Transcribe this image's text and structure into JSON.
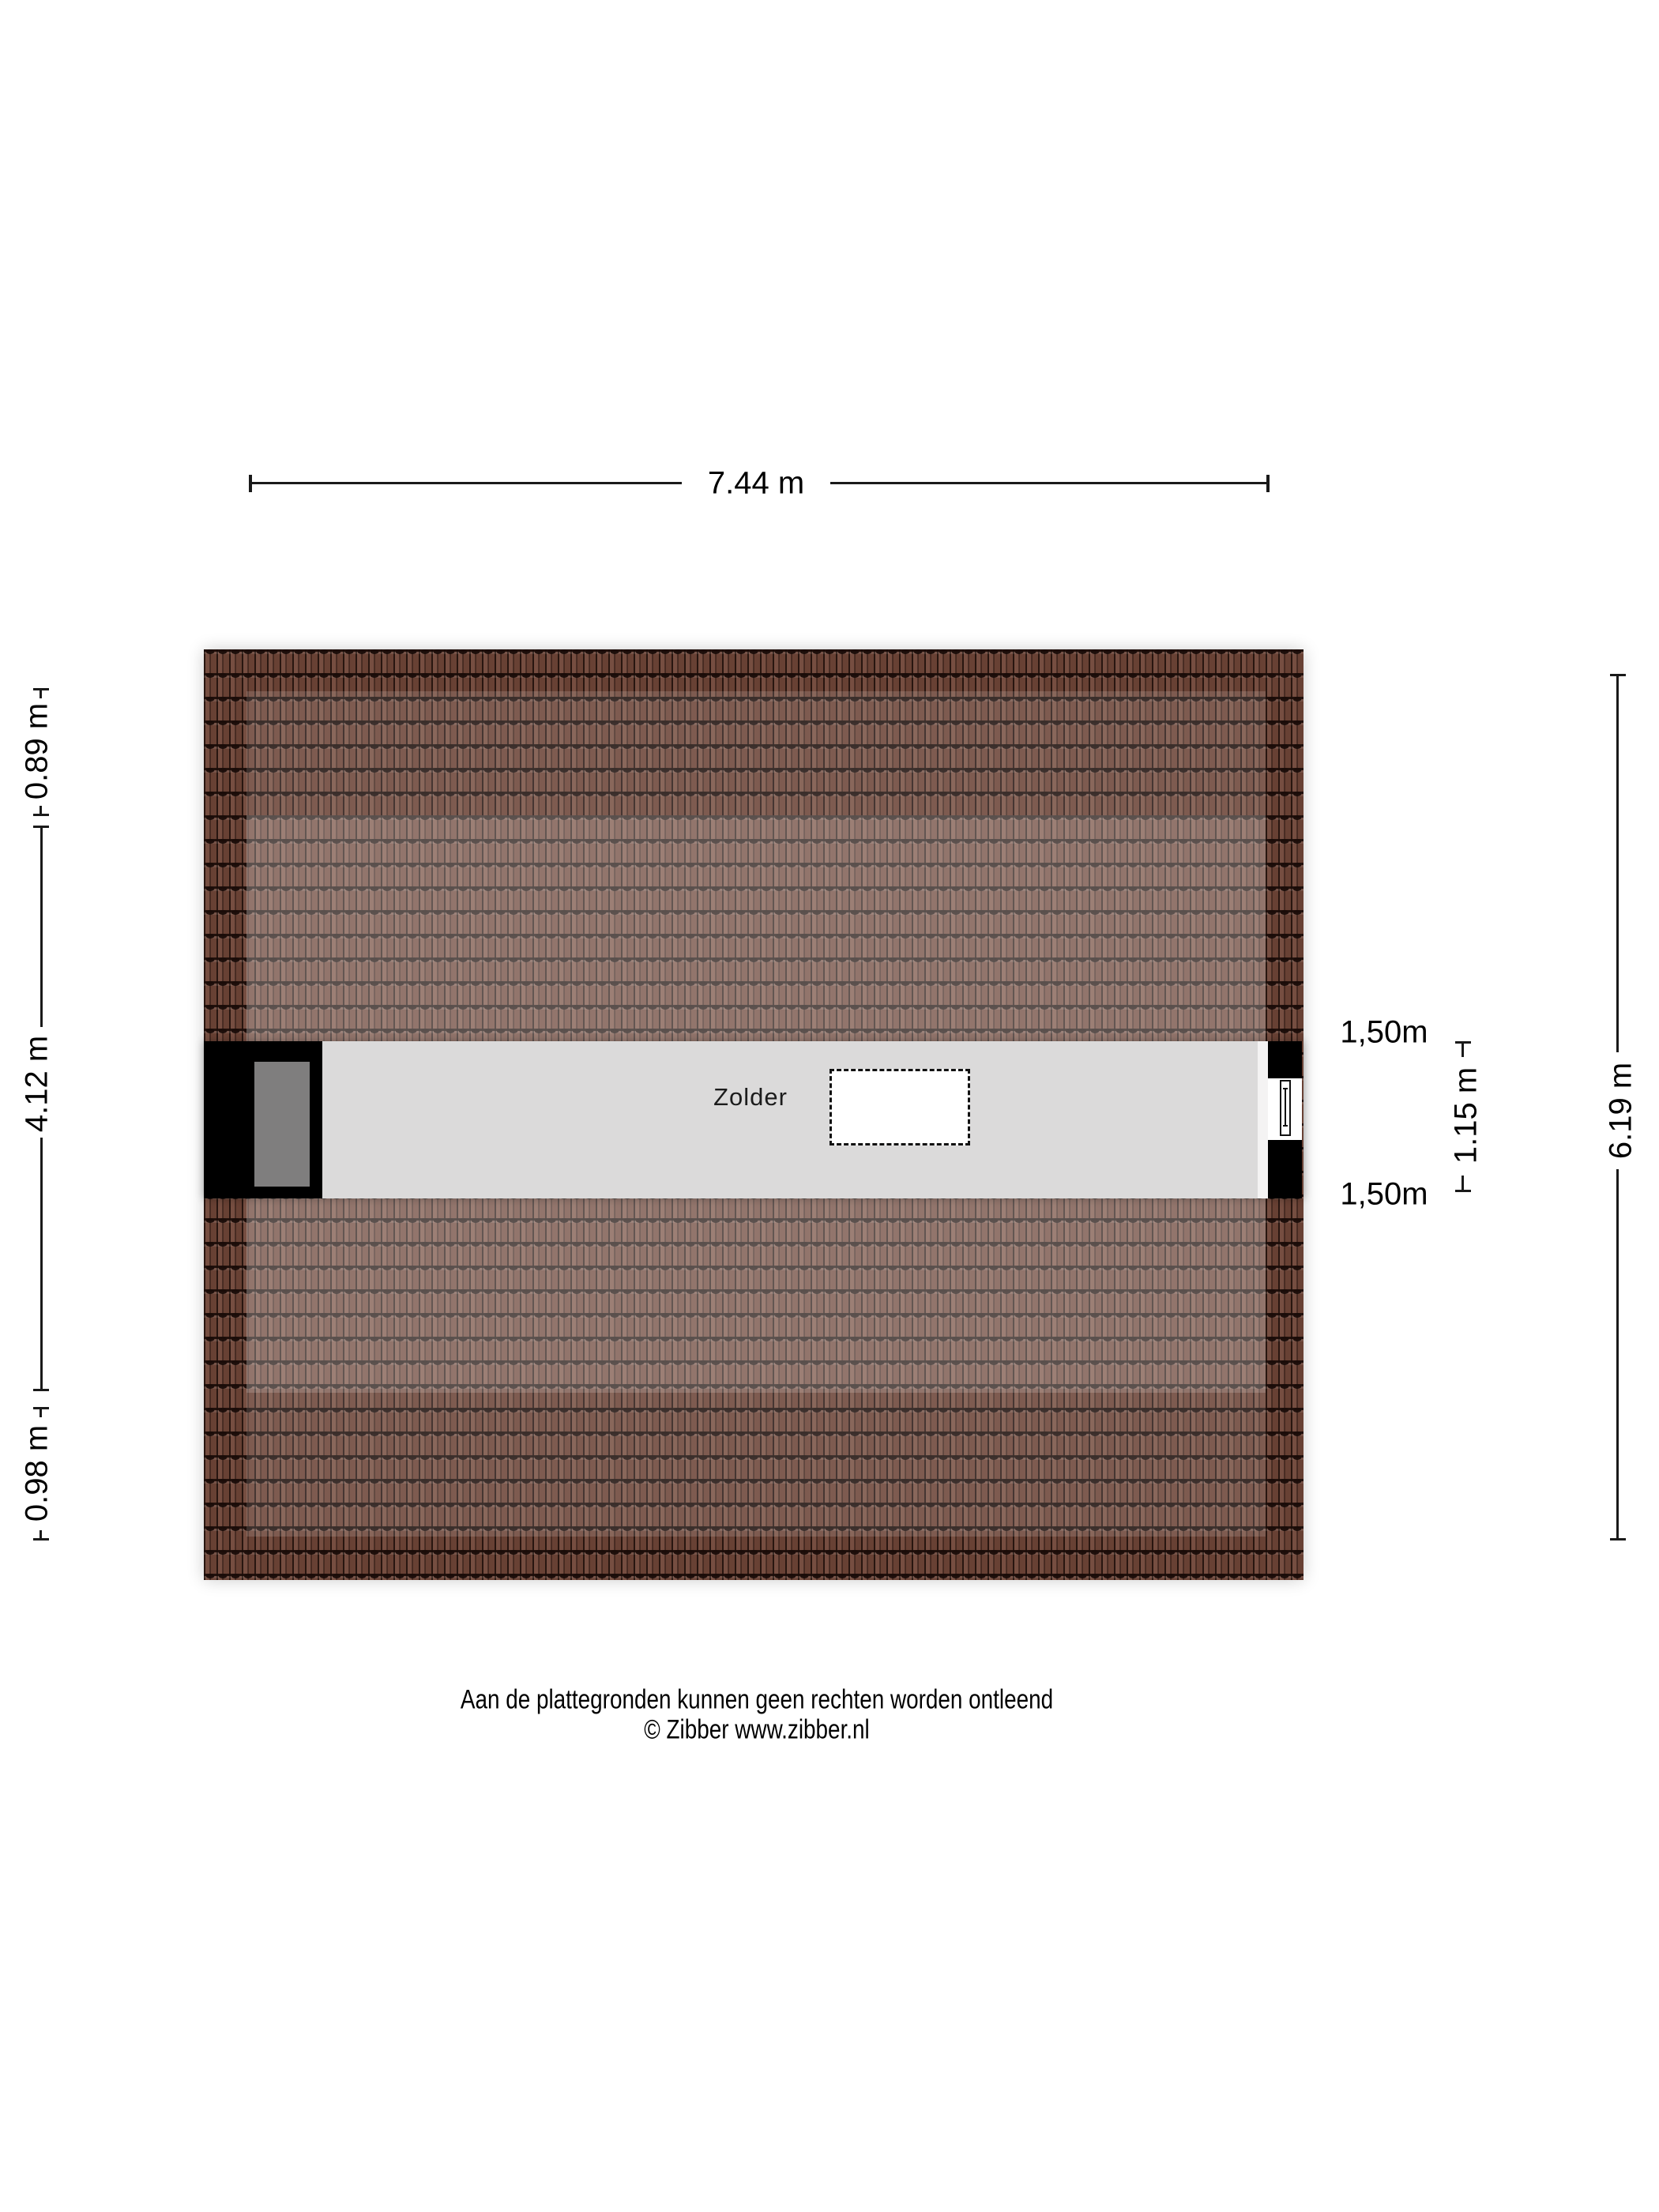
{
  "plan": {
    "room": {
      "label": "Zolder"
    },
    "dimensions": {
      "top_width": "7.44 m",
      "left_upper": "0.89 m",
      "left_middle": "4.12 m",
      "left_lower": "0.98 m",
      "band_upper_offset": "1,50m",
      "band_height": "1.15 m",
      "band_lower_offset": "1,50m",
      "right_total": "6.19 m"
    },
    "colors": {
      "roof_tile_base": "#6f4537",
      "roof_tile_line": "#2a1a12",
      "floor": "#dbdada",
      "wall": "#000000",
      "chimney": "#7f7e7e",
      "stair_opening_fill": "#ffffff",
      "dimension_text": "#000000"
    }
  },
  "footer": {
    "disclaimer": "Aan de plattegronden kunnen geen rechten worden ontleend",
    "copyright": "© Zibber www.zibber.nl"
  }
}
